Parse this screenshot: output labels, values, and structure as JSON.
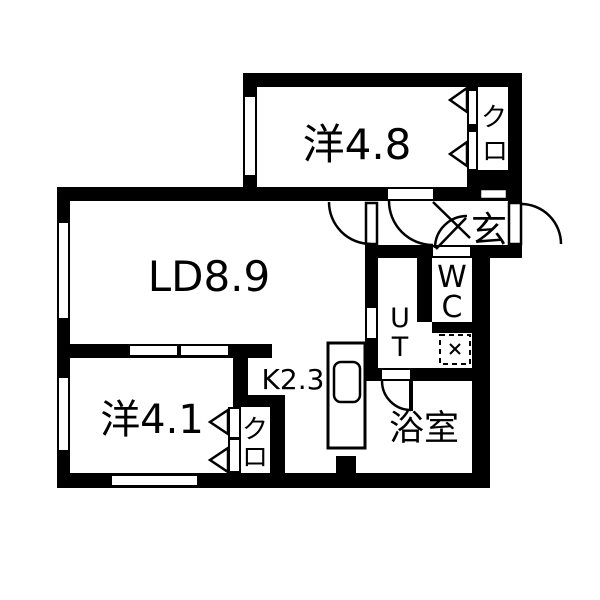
{
  "colors": {
    "wall": "#000000",
    "floor": "#ffffff"
  },
  "floorplan": {
    "rooms": {
      "living_dining": {
        "label": "LD8.9"
      },
      "western_room_top": {
        "label": "洋4.8"
      },
      "western_room_bottom": {
        "label": "洋4.1"
      },
      "kitchen": {
        "label": "K2.3"
      },
      "entrance": {
        "label": "玄"
      },
      "bathroom": {
        "label": "浴室"
      },
      "toilet": {
        "chars": [
          "W",
          "C"
        ]
      },
      "utility": {
        "chars": [
          "U",
          "T"
        ]
      },
      "closet_top": {
        "chars": [
          "ク",
          "ロ"
        ]
      },
      "closet_bottom": {
        "chars": [
          "ク",
          "ロ"
        ]
      }
    }
  }
}
